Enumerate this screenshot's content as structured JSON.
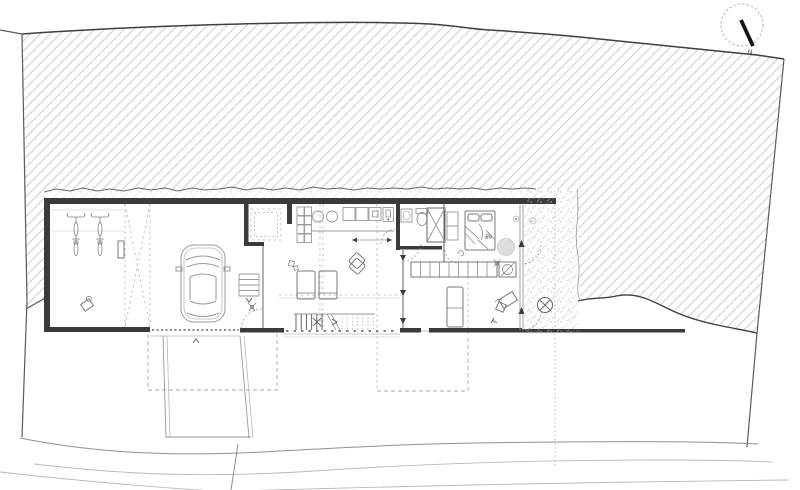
{
  "north": {
    "label": "N"
  },
  "colors": {
    "paper": "#ffffff",
    "ink": "#3a3a3a",
    "site": "#5a5a5a",
    "contour": "#3f3f3f",
    "hatch": "#cccccc",
    "stipple": "#b5b5b5",
    "line": "#666666",
    "light": "#999999",
    "faint": "#b8b8b8",
    "dashedcol": "#aaaaaa",
    "car": "#9a9a9a",
    "furniture": "#787878",
    "rug": "#dedede",
    "roadcol": "#919191",
    "needle": "#141414",
    "text": "#444444"
  }
}
